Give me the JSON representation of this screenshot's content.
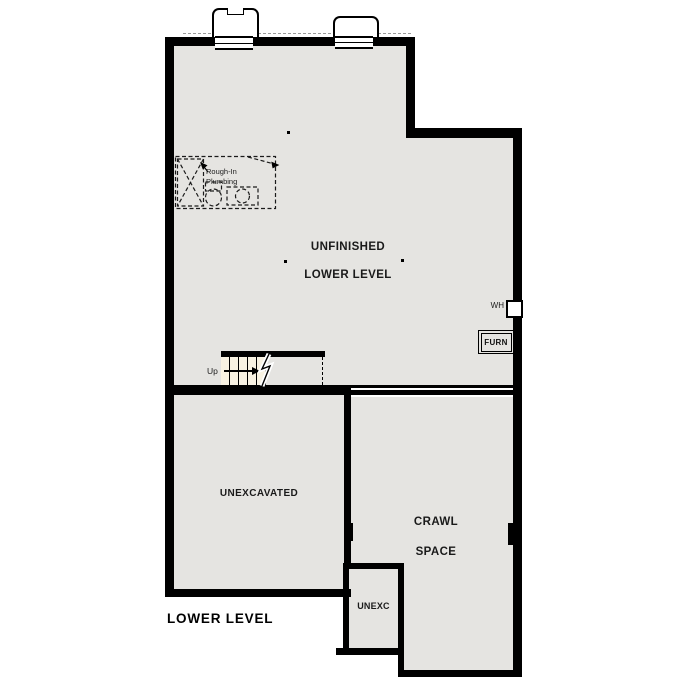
{
  "page": {
    "title": "LOWER LEVEL"
  },
  "rooms": {
    "main": {
      "line1": "UNFINISHED",
      "line2": "LOWER LEVEL"
    },
    "unexcavated": {
      "label": "UNEXCAVATED"
    },
    "crawl_space": {
      "line1": "CRAWL",
      "line2": "SPACE"
    },
    "unexc": {
      "label": "UNEXC"
    }
  },
  "labels": {
    "up": "Up",
    "rough_in_line1": "Rough-In",
    "rough_in_line2": "Plumbing",
    "water_heater": "WH",
    "furnace": "FURN"
  },
  "colors": {
    "wall": "#000000",
    "floor": "#e5e4e1",
    "stair_fill": "#f8f2e2",
    "background": "#ffffff"
  }
}
